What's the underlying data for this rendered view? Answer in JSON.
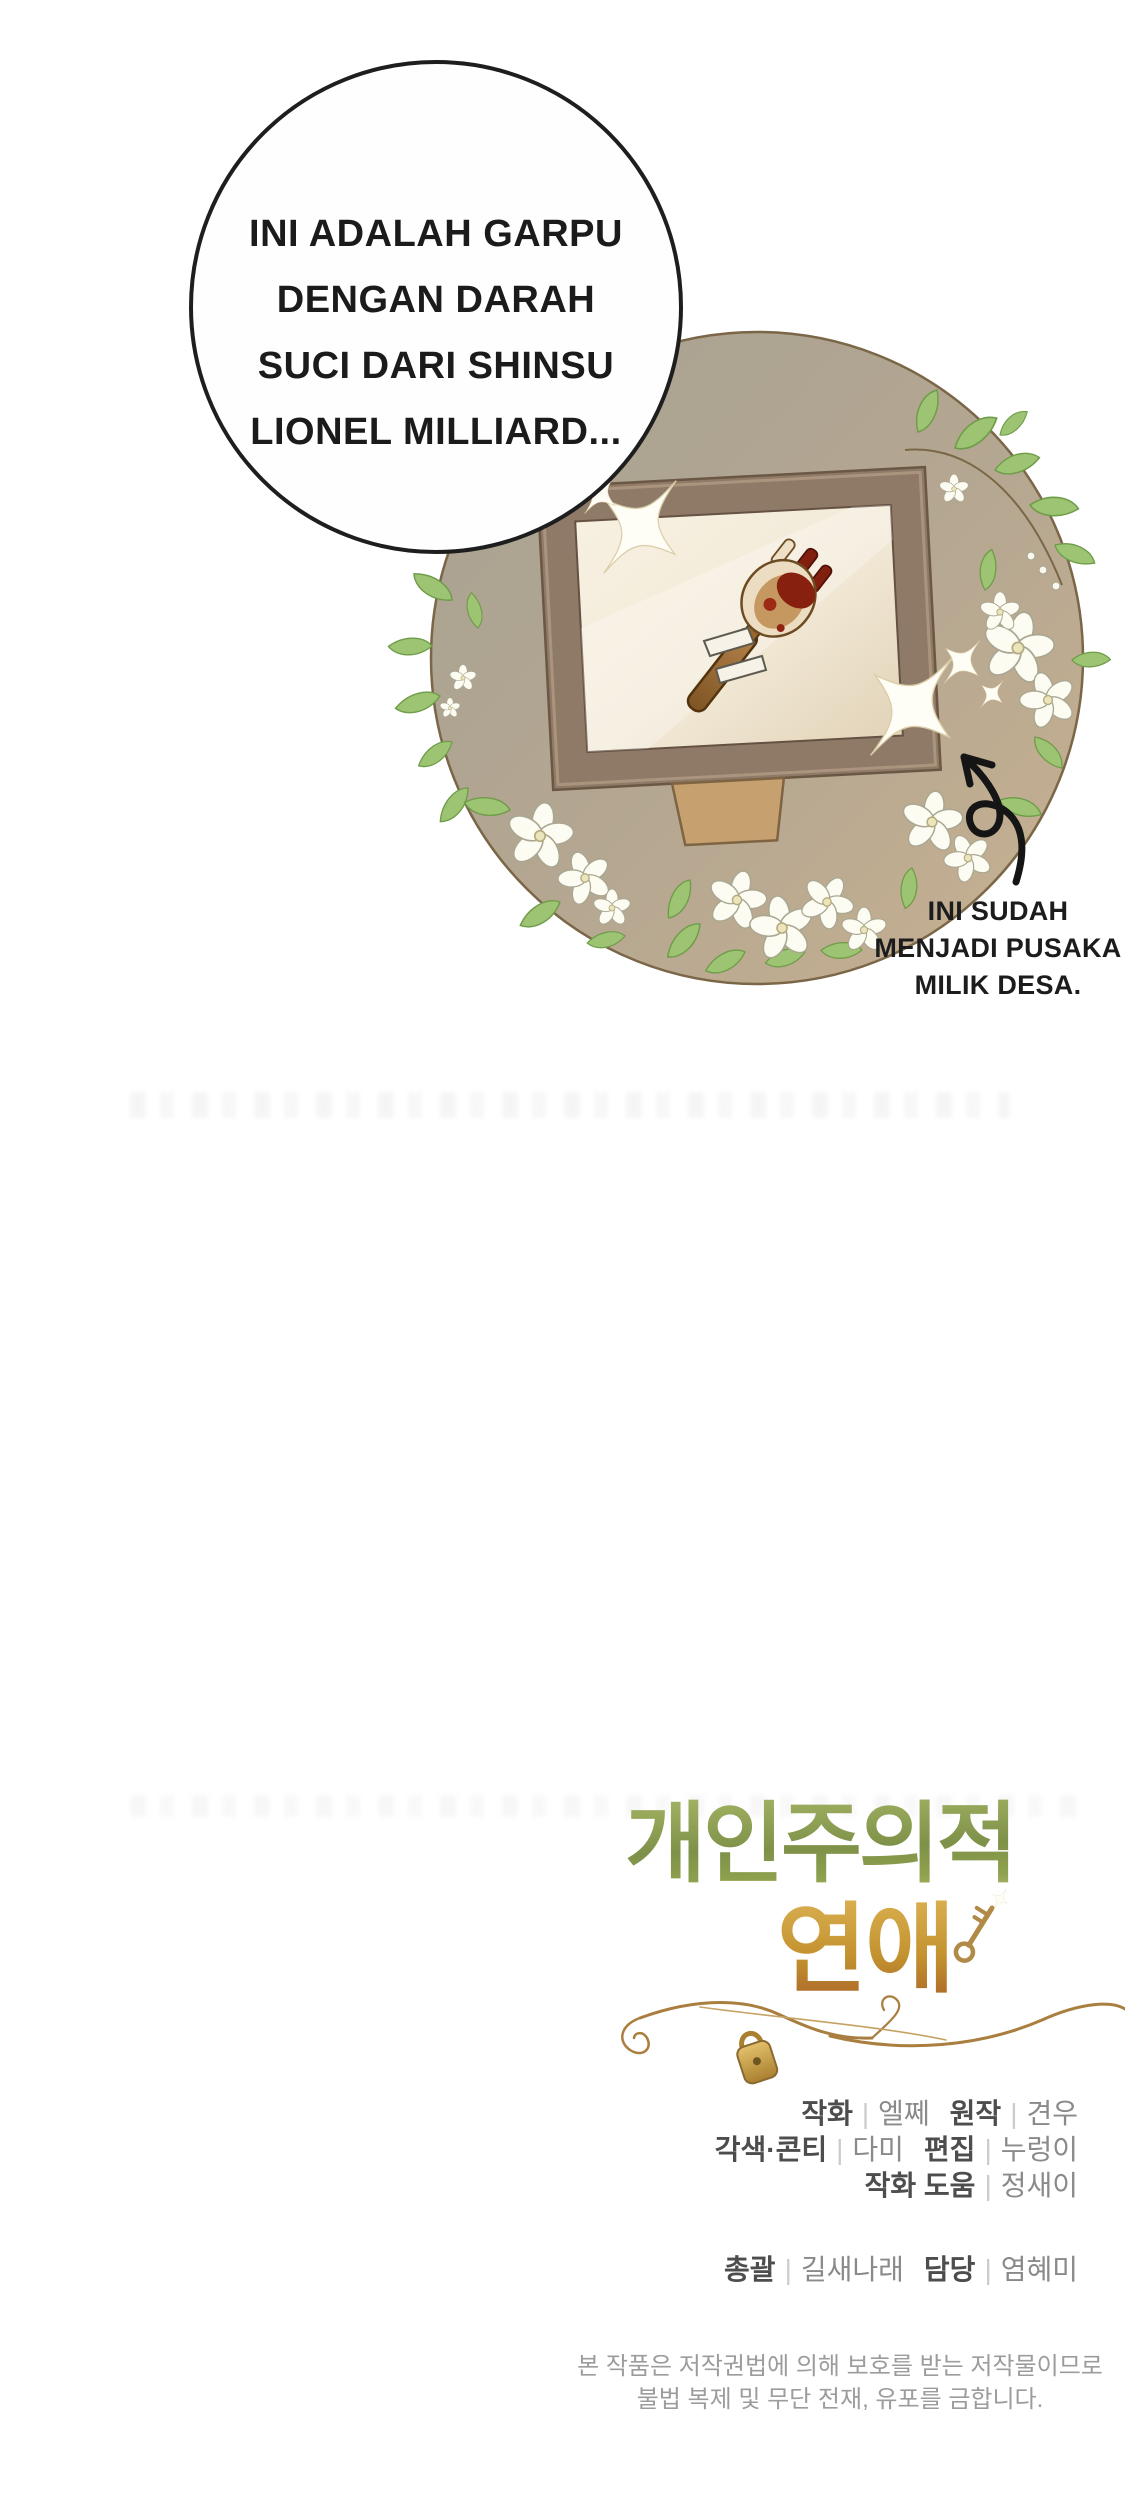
{
  "page": {
    "background": "#ffffff",
    "width": 1125,
    "height": 2494
  },
  "speech_bubble": {
    "line1": "INI ADALAH GARPU",
    "line2": "DENGAN DARAH",
    "line3": "SUCI DARI SHINSU",
    "line4": "LIONEL MILLIARD..."
  },
  "illustration": {
    "caption": {
      "line1": "INI SUDAH",
      "line2": "MENJADI PUSAKA",
      "line3": "MILIK DESA."
    },
    "colors": {
      "vignette_olive": "#a7a193",
      "vignette_tan": "#c8b191",
      "frame_brown": "#8f7a68",
      "mat_cream": "#f3ebd9",
      "stand_tan": "#c6a06e",
      "fork_wood": "#a06c31",
      "blood_red": "#7e1f10",
      "leaf_green": "#9cc473",
      "flower_white": "#fdfcf2",
      "vine_brown": "#7b6647",
      "sparkle_white": "#fffef6",
      "arrow_black": "#151515"
    }
  },
  "title": {
    "line1": "개인주의적",
    "line2": "연애",
    "green_top": "#a3b364",
    "green_bottom": "#7e9148",
    "gold_top": "#dcb253",
    "gold_bottom": "#b0702a",
    "charm_gold": "#b08a46"
  },
  "credits": {
    "separator": "|",
    "label_color": "#4d4d4d",
    "name_color": "#8a8a8a",
    "separator_color": "#cccccc",
    "row1": {
      "label1": "작화",
      "name1": "엘쩨",
      "label2": "원작",
      "name2": "견우"
    },
    "row2": {
      "label1": "각색·콘티",
      "name1": "다미",
      "label2": "편집",
      "name2": "누렁이"
    },
    "row3": {
      "label1": "작화 도움",
      "name1": "정새이"
    },
    "row4": {
      "label1": "총괄",
      "name1": "길새나래",
      "label2": "담당",
      "name2": "염혜미"
    }
  },
  "copyright": {
    "color": "#9c9c9c",
    "line1": "본 작품은 저작권법에 의해 보호를 받는 저작물이므로",
    "line2": "불법 복제 및 무단 전재, 유포를 금합니다."
  }
}
